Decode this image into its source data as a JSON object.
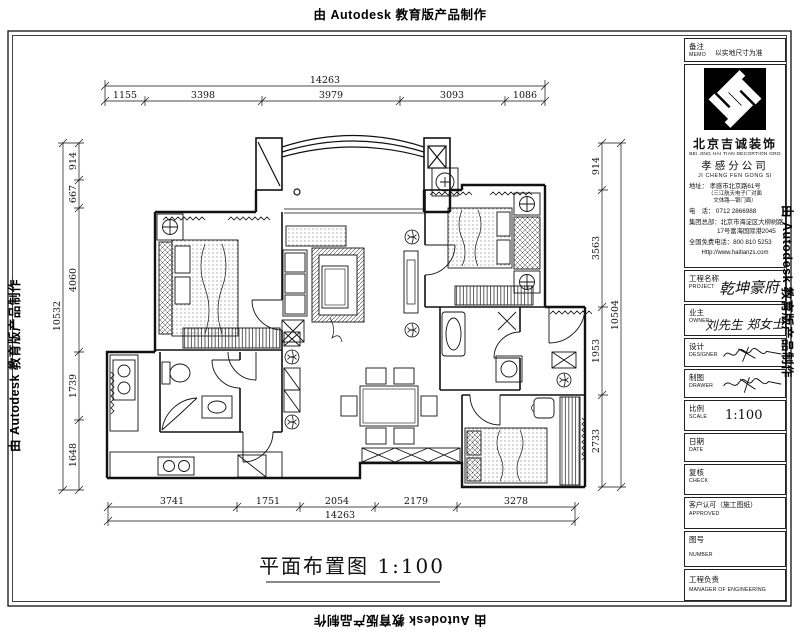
{
  "stamp": {
    "text": "由 Autodesk 教育版产品制作"
  },
  "drawing": {
    "title": "平面布置图  1:100",
    "dims": {
      "top": {
        "overall": "14263",
        "segments": [
          "1155",
          "3398",
          "3979",
          "3093",
          "1086"
        ]
      },
      "bottom": {
        "overall": "14263",
        "segments": [
          "3741",
          "1751",
          "2054",
          "2179",
          "3278"
        ]
      },
      "left": {
        "overall": "10532",
        "segments": [
          "914",
          "667",
          "4060",
          "1739",
          "1648"
        ]
      },
      "right": {
        "overall": "10504",
        "segments": [
          "914",
          "3563",
          "1953",
          "2733"
        ]
      }
    }
  },
  "titleblock": {
    "memo": {
      "label": "备注",
      "en": "MEMO",
      "value": "以实地尺寸为准"
    },
    "company": {
      "name_cn": "北京吉诚装饰",
      "name_en": "BEI JING HAI TIAN DECORTION GRO",
      "branch_cn": "孝感分公司",
      "branch_en": "JI CHENG FEN GONG SI",
      "address_line": "地址： 孝感市北京路61号",
      "address_note1": "（三江航天电子厂对面",
      "address_note2": "文体路—银门面）",
      "tel_line": "电　话： 0712 2866988",
      "hq_line1": "集团总部：北京市海淀区大柳树路",
      "hq_line2": "17号富海国际港2045",
      "hotline_line": "全国免费电话：800 810 5253",
      "website": "Http://www.haitianzs.com"
    },
    "project": {
      "label": "工程名称",
      "en": "PROJECT",
      "value": "乾坤豪府"
    },
    "owner": {
      "label": "业主",
      "en": "OWNER",
      "value": "刘先生  郑女士"
    },
    "designer": {
      "label": "设计",
      "en": "DESIGNER"
    },
    "drawer": {
      "label": "制图",
      "en": "DRAWER"
    },
    "scale": {
      "label": "比例",
      "en": "SCALE",
      "value": "1:100"
    },
    "date": {
      "label": "日期",
      "en": "DATE"
    },
    "check": {
      "label": "复核",
      "en": "CHECK"
    },
    "approved": {
      "label": "客户认可（施工图纸）",
      "en": "APPROVED"
    },
    "number": {
      "label": "图号",
      "en": "NUMBER"
    },
    "manager": {
      "label": "工程负责",
      "en": "MANAGER OF ENGINEERING"
    }
  },
  "colors": {
    "line": "#111111",
    "logo": "#000000",
    "paper": "#ffffff"
  }
}
